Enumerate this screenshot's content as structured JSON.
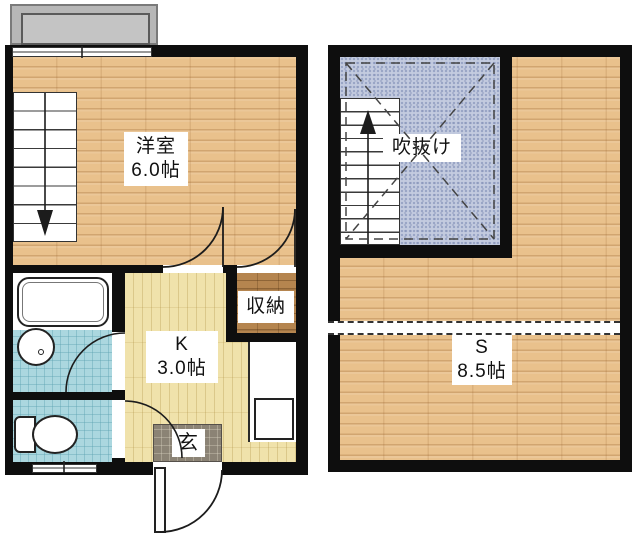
{
  "plan1": {
    "room": {
      "name": "洋室",
      "size": "6.0帖"
    },
    "kitchen": {
      "name": "K",
      "size": "3.0帖"
    },
    "closet": {
      "name": "収納"
    },
    "entrance": {
      "name": "玄"
    }
  },
  "plan2": {
    "void": {
      "name": "吹抜け"
    },
    "room": {
      "name": "S",
      "size": "8.5帖"
    }
  },
  "colors": {
    "wall": "#0e0e0e",
    "wood_floor": "#e9c18c",
    "kitchen_floor": "#f0e2ab",
    "closet_floor": "#b5854f",
    "bath_tile": "#abd7df",
    "void_blue": "#c3cbdf",
    "genkan_tile": "#8b8375",
    "balcony_gray": "#b7b7b7"
  }
}
